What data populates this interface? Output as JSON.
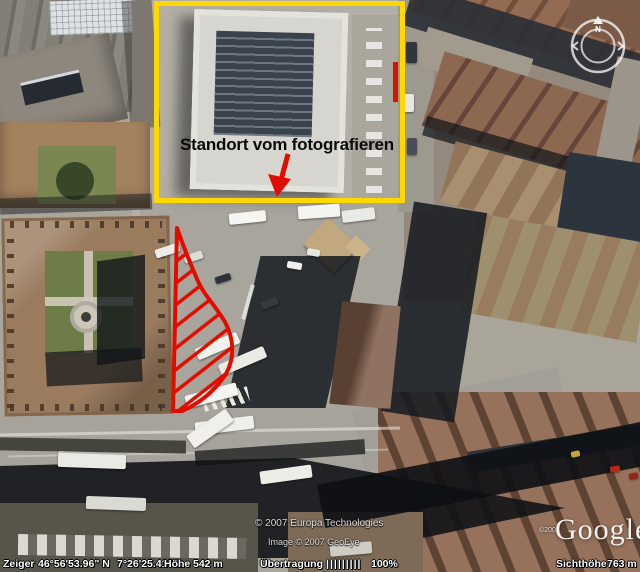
{
  "palette": {
    "highlight_box": "#ffd800",
    "annotation_red": "#e10c00"
  },
  "annotations": {
    "standort_label": "Standort vom fotografieren"
  },
  "compass": {
    "north_label": "N"
  },
  "credits": {
    "provider_line": "© 2007 Europa Technologies",
    "image_line": "Image © 2007 GeoEye",
    "logo_copyright": "©2007",
    "logo_text": "Google"
  },
  "status_bar": {
    "pointer_label": "Zeiger",
    "pointer_lat": "46°56'53.96\" N",
    "pointer_lon": "7°26'25.41\" O",
    "elevation_label": "Höhe",
    "elevation_value": "542 m",
    "streaming_label": "Übertragung",
    "streaming_meter": "|||||||||",
    "streaming_percent": "100%",
    "eye_altitude_label": "Sichthöhe",
    "eye_altitude_value": "763 m"
  }
}
